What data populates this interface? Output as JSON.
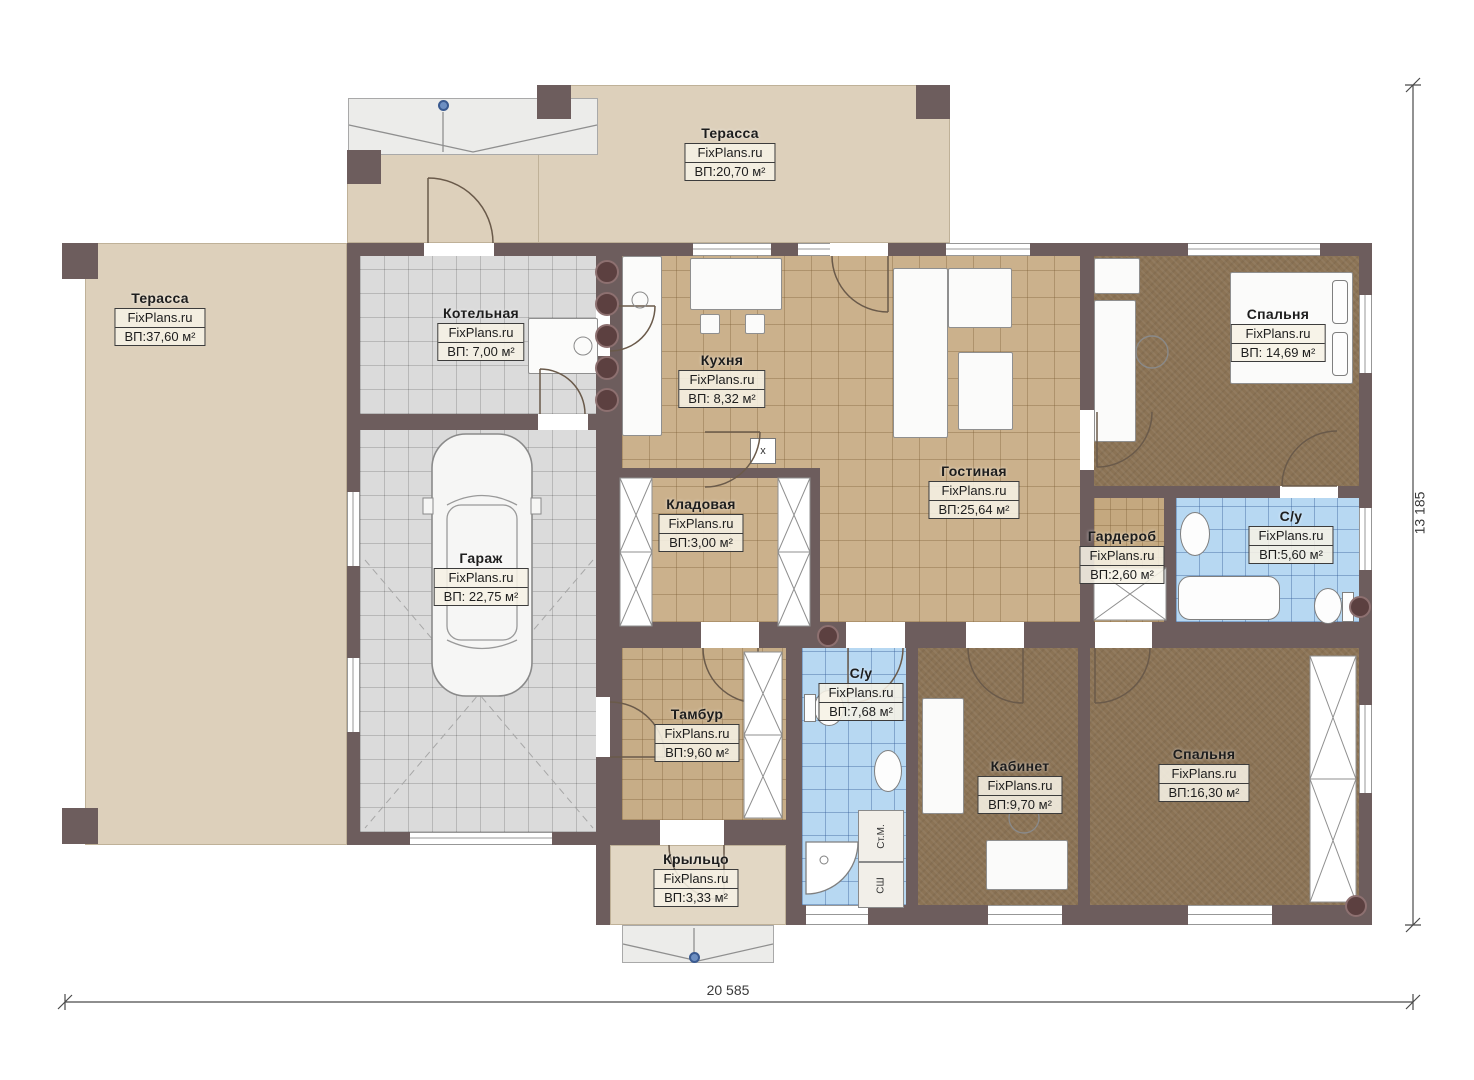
{
  "meta": {
    "brand": "FixPlans.ru",
    "type": "floor-plan"
  },
  "dimensions": {
    "bottom": "20 585",
    "right": "13 185"
  },
  "rooms": {
    "terrace_top": {
      "name": "Терасса",
      "brand": "FixPlans.ru",
      "area": "ВП:20,70 м²"
    },
    "terrace_left": {
      "name": "Терасса",
      "brand": "FixPlans.ru",
      "area": "ВП:37,60 м²"
    },
    "boiler": {
      "name": "Котельная",
      "brand": "FixPlans.ru",
      "area": "ВП: 7,00 м²"
    },
    "kitchen": {
      "name": "Кухня",
      "brand": "FixPlans.ru",
      "area": "ВП: 8,32 м²"
    },
    "living": {
      "name": "Гостиная",
      "brand": "FixPlans.ru",
      "area": "ВП:25,64 м²"
    },
    "bedroom1": {
      "name": "Спальня",
      "brand": "FixPlans.ru",
      "area": "ВП: 14,69 м²"
    },
    "pantry": {
      "name": "Кладовая",
      "brand": "FixPlans.ru",
      "area": "ВП:3,00 м²"
    },
    "garage": {
      "name": "Гараж",
      "brand": "FixPlans.ru",
      "area": "ВП: 22,75 м²"
    },
    "wardrobe": {
      "name": "Гардероб",
      "brand": "FixPlans.ru",
      "area": "ВП:2,60 м²"
    },
    "bath1": {
      "name": "С/у",
      "brand": "FixPlans.ru",
      "area": "ВП:5,60 м²"
    },
    "tambur": {
      "name": "Тамбур",
      "brand": "FixPlans.ru",
      "area": "ВП:9,60 м²"
    },
    "bath2": {
      "name": "С/у",
      "brand": "FixPlans.ru",
      "area": "ВП:7,68 м²"
    },
    "office": {
      "name": "Кабинет",
      "brand": "FixPlans.ru",
      "area": "ВП:9,70 м²"
    },
    "bedroom2": {
      "name": "Спальня",
      "brand": "FixPlans.ru",
      "area": "ВП:16,30 м²"
    },
    "porch": {
      "name": "Крыльцо",
      "brand": "FixPlans.ru",
      "area": "ВП:3,33 м²"
    }
  },
  "appliances": {
    "washer": "Ст.М.",
    "dryer": "СШ",
    "shaft": "х"
  },
  "colors": {
    "wall": "#6d5d5d",
    "terrace": "#ddd0bb",
    "tile_tan": "#cbb18c",
    "floor_brown": "#8b7355",
    "tile_blue": "#b7d8f2",
    "tile_gray": "#dbdbdb"
  }
}
